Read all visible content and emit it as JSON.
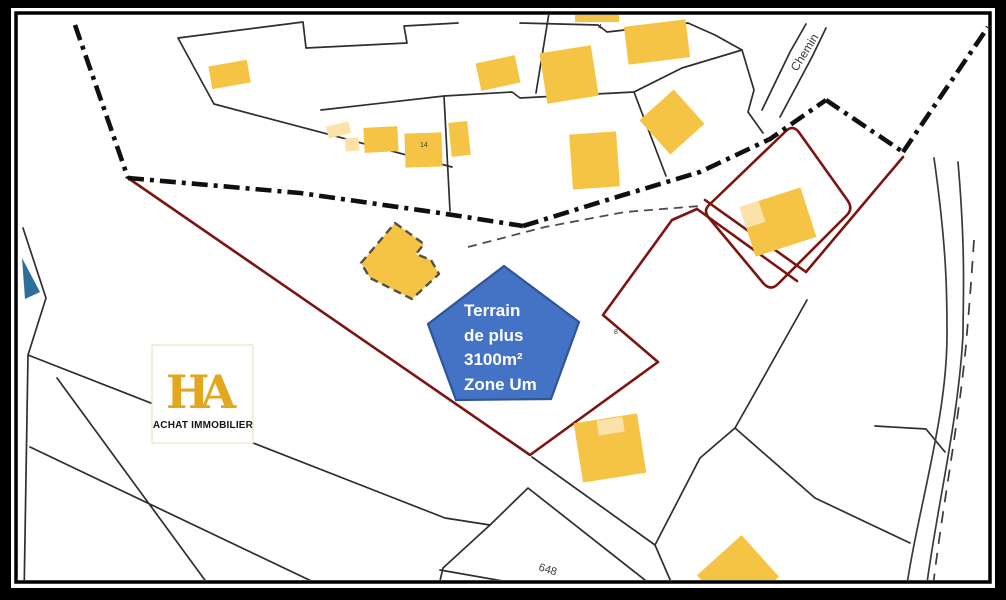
{
  "map": {
    "pentagon": {
      "lines": [
        "Terrain",
        "de plus",
        "3100m²",
        "Zone Um"
      ],
      "fill": "#4472C4",
      "stroke": "#2F5597",
      "text_color": "#FFFFFF"
    },
    "logo": {
      "monogram": "HA",
      "subtitle": "ACHAT IMMOBILIER",
      "gold": "#E2A71E"
    },
    "labels": {
      "road_name": "Chemin",
      "parcel_number_648": "648",
      "building_number_14": "14",
      "parcel_number_4": "4",
      "parcel_number_8": "8"
    },
    "colors": {
      "building": "#F6C445",
      "building_light": "#FAE2A8",
      "parcel_line": "#2E2E2E",
      "boundary": "#101010",
      "red_outline": "#7B150F",
      "water": "#2D6F99",
      "frame": "#000000",
      "background": "#FFFFFF"
    }
  }
}
